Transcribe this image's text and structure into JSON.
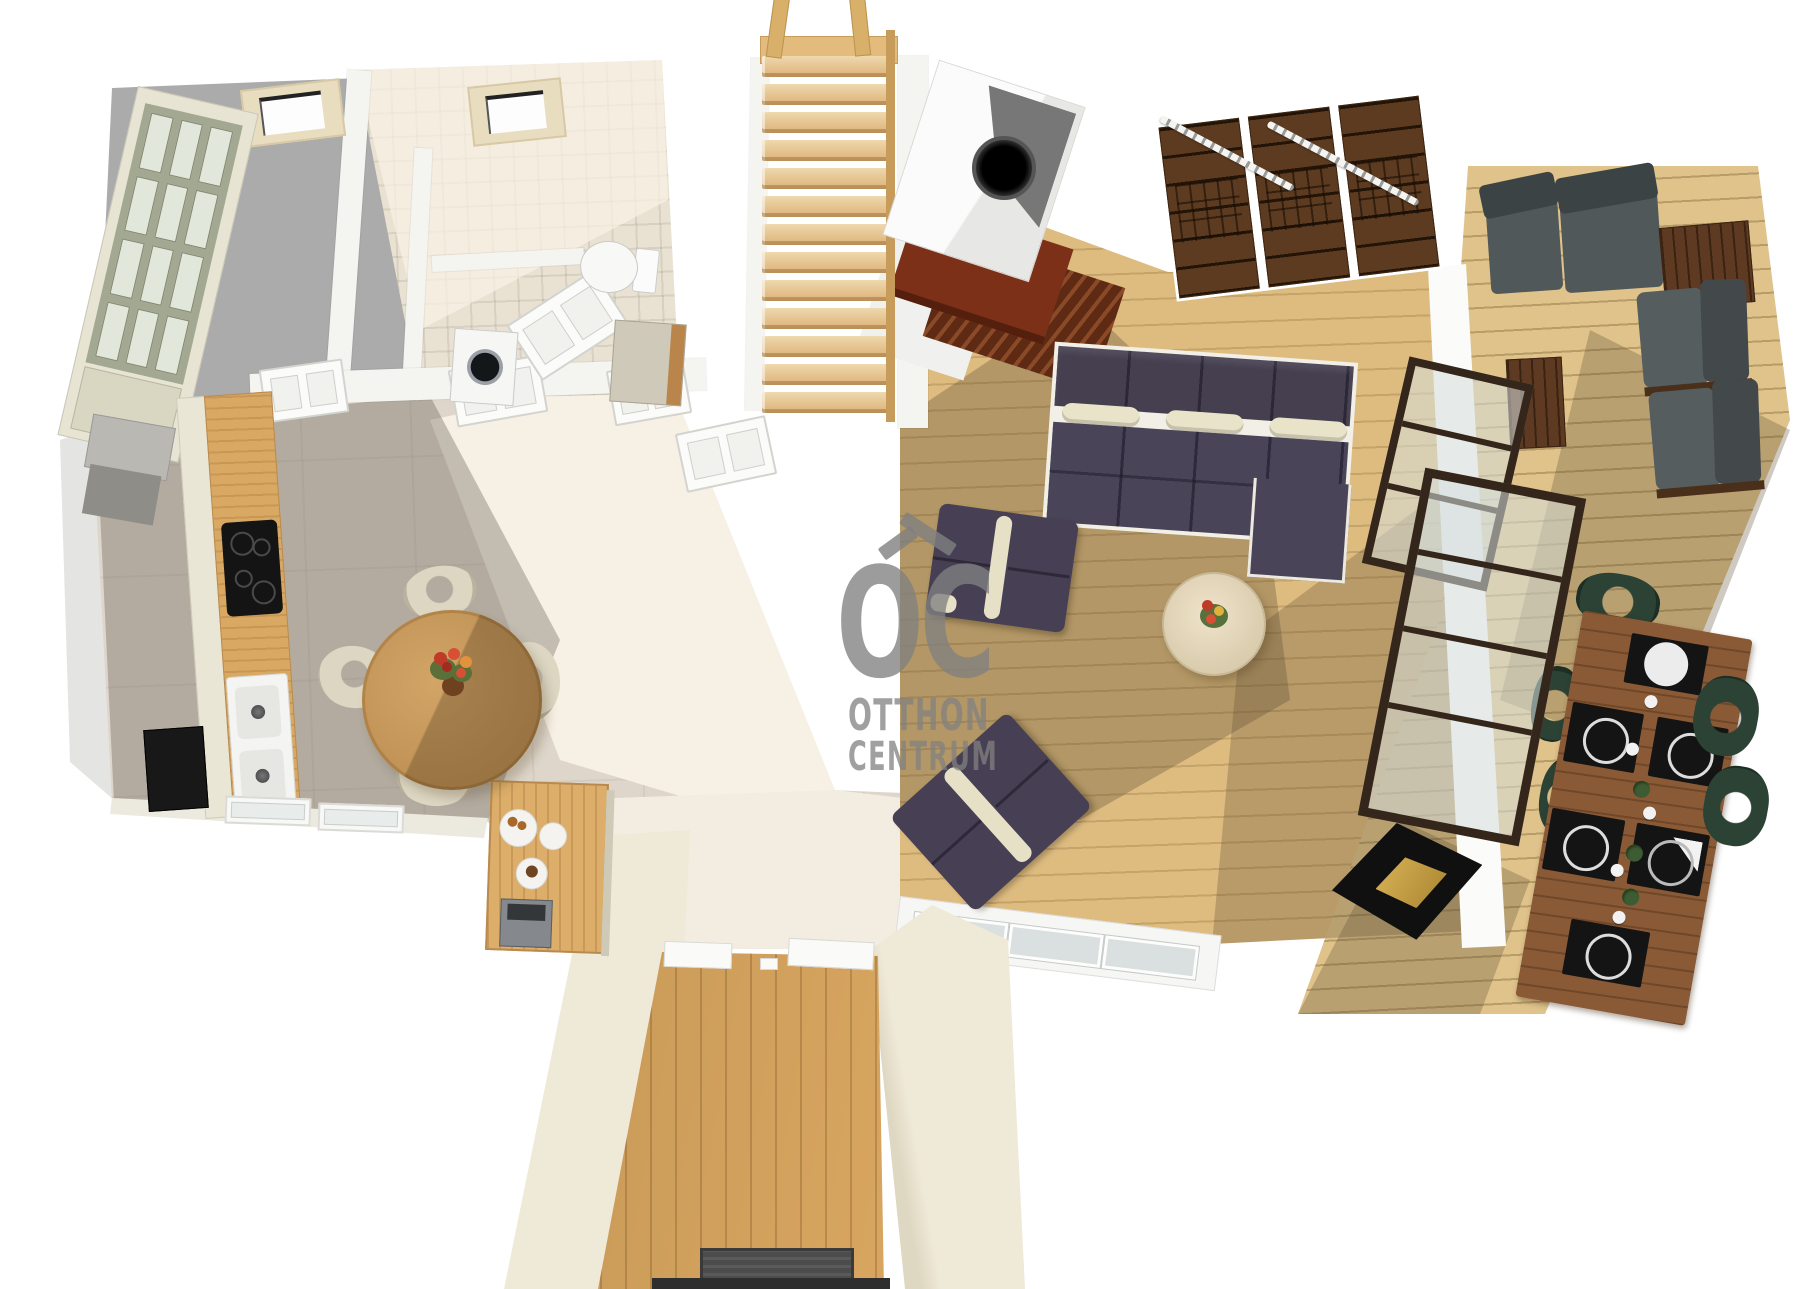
{
  "watermark": {
    "logo_text": "OC",
    "line1": "OTTHON",
    "line2": "CENTRUM",
    "color": "#808080"
  },
  "palette": {
    "background": "#ffffff",
    "roof_gray": "#ababab",
    "kitchen_tile": "#efe8dd",
    "bath_tile": "#e9e1d2",
    "living_wood": "#debc80",
    "deck_wood": "#dfc38b",
    "hall_wood": "#d8a660",
    "stair_wood": "#e2bb7d",
    "sofa_navy": "#4a4458",
    "cushion_cream": "#e9e3c9",
    "bookshelf_brown": "#5d3b20",
    "hearth_red": "#7c3018",
    "outdoor_cushion_gray": "#51585a",
    "outdoor_frame_brown": "#5d3a21",
    "dining_chair_green": "#2b4234",
    "table_black": "#101010",
    "table_gold": "#d9b458",
    "wall_cream": "#efe9d8"
  },
  "counts": {
    "stair_treads": 13,
    "bookshelf_modules": 3,
    "sofa_headrest_cushions": 3,
    "skylights": 2,
    "kitchen_chairs": 4,
    "outdoor_placemats": 6,
    "outdoor_dining_chairs": 6
  }
}
